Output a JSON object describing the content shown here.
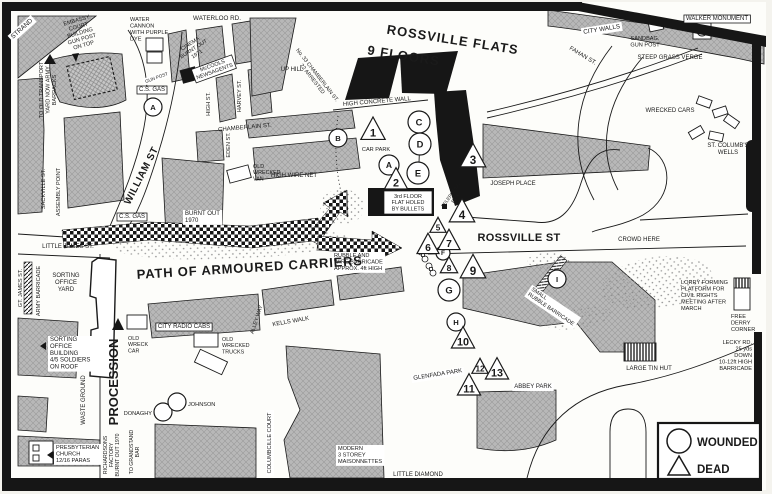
{
  "legend": {
    "wounded_label": "WOUNDED",
    "dead_label": "DEAD"
  },
  "colors": {
    "building_grey": "#b8b8b8",
    "flats_black": "#161616",
    "ink": "#1a1a1a",
    "paper": "#f4f3ee"
  },
  "labels": [
    {
      "n": "strand",
      "t": "STRAND",
      "x": 23,
      "y": 30,
      "s": 6.5,
      "r": -42,
      "box": 2
    },
    {
      "n": "embassy-court",
      "t": "EMBASSY\nCOURT\nBUILDING\nGUN POST\nON TOP",
      "x": 77,
      "y": 22,
      "s": 5.6,
      "r": -16
    },
    {
      "n": "water-cannon",
      "t": "WATER\nCANNON\nWITH PURPLE\nDYE",
      "x": 130,
      "y": 21,
      "s": 5.6,
      "a": "s"
    },
    {
      "n": "waterloo-rd",
      "t": "WATERLOO RD.",
      "x": 217,
      "y": 20,
      "s": 6.3
    },
    {
      "n": "transport-yard",
      "t": "TO OLD TRANSPORT\nYARD NOW ARMY\nBARRACKS",
      "x": 43,
      "y": 90,
      "s": 5.6,
      "r": -90
    },
    {
      "n": "cinema-burnt-out",
      "t": "CINEMA\nBURNT OUT\n1971",
      "x": 191,
      "y": 45,
      "s": 5.4,
      "r": -33
    },
    {
      "n": "mccools-newsagents",
      "t": "McCOOLS\nNEWSAGENTS",
      "x": 213,
      "y": 67,
      "s": 5.4,
      "r": -20,
      "box": 1
    },
    {
      "n": "cs-gas-north",
      "t": "C.S. GAS",
      "x": 152,
      "y": 91,
      "s": 6,
      "box": 1
    },
    {
      "n": "gun-post",
      "t": "GUN POST",
      "x": 157,
      "y": 79,
      "s": 4.6,
      "r": -20,
      "box": 2
    },
    {
      "n": "high-st",
      "t": "HIGH ST.",
      "x": 210,
      "y": 104,
      "s": 5.6,
      "r": -90
    },
    {
      "n": "harvey-st",
      "t": "HARVEY ST.",
      "x": 241,
      "y": 96,
      "s": 5.6,
      "r": -90
    },
    {
      "n": "chamberlain-st",
      "t": "CHAMBERLAIN ST.",
      "x": 245,
      "y": 129,
      "s": 6,
      "r": -5
    },
    {
      "n": "eden-st",
      "t": "EDEN ST.",
      "x": 230,
      "y": 145,
      "s": 5.6,
      "r": -90
    },
    {
      "n": "up-hill",
      "t": "UP HILL",
      "x": 292,
      "y": 71,
      "s": 6
    },
    {
      "n": "no33-chamberlain",
      "t": "No. 33 CHAMBERLAIN ST.\n22 ARRESTED",
      "x": 316,
      "y": 76,
      "s": 5.4,
      "r": 52
    },
    {
      "n": "rossville-flats",
      "t": "ROSSVILLE FLATS",
      "x": 452,
      "y": 44,
      "s": 13,
      "r": 9,
      "b": 1,
      "ls": 1
    },
    {
      "n": "nine-floors",
      "t": "9 FLOORS",
      "x": 403,
      "y": 60,
      "s": 13,
      "r": 9,
      "b": 1,
      "ls": 1
    },
    {
      "n": "high-concrete-wall",
      "t": "HIGH CONCRETE WALL",
      "x": 377,
      "y": 103,
      "s": 6,
      "r": -5
    },
    {
      "n": "car-park",
      "t": "CAR PARK",
      "x": 376,
      "y": 151,
      "s": 5.6
    },
    {
      "n": "old-wrecked-van",
      "t": "OLD\nWRECKED\nVAN",
      "x": 253,
      "y": 168,
      "s": 5.4,
      "a": "s"
    },
    {
      "n": "high-wire-net",
      "t": "HIGH WIRE NET",
      "x": 294,
      "y": 177,
      "s": 6
    },
    {
      "n": "cs-gas-south",
      "t": "C.S. GAS",
      "x": 132,
      "y": 218,
      "s": 6,
      "box": 1
    },
    {
      "n": "burnt-out-1970",
      "t": "BURNT OUT\n1970",
      "x": 185,
      "y": 215,
      "s": 6,
      "a": "s",
      "box": 2
    },
    {
      "n": "william-st",
      "t": "WILLIAM ST",
      "x": 144,
      "y": 177,
      "s": 10,
      "r": -63,
      "b": 1,
      "ls": 0.5
    },
    {
      "n": "sackville-st",
      "t": "SACKVILLE ST.",
      "x": 45,
      "y": 189,
      "s": 5.6,
      "r": -90
    },
    {
      "n": "assembly-point",
      "t": "ASSEMBLY POINT",
      "x": 60,
      "y": 192,
      "s": 5.6,
      "r": -90
    },
    {
      "n": "little-james-st",
      "t": "LITTLE JAMES ST.",
      "x": 68,
      "y": 248,
      "s": 6
    },
    {
      "n": "third-floor-flat",
      "t": "3rd FLOOR\nFLAT HOLED\nBY BULLETS",
      "x": 408,
      "y": 198,
      "s": 5.4
    },
    {
      "n": "telephone-box",
      "t": "TELEPHONE\nBOX",
      "x": 452,
      "y": 196,
      "s": 4.8,
      "r": -55
    },
    {
      "n": "joseph-place",
      "t": "JOSEPH PLACE",
      "x": 513,
      "y": 185,
      "s": 6
    },
    {
      "n": "rossville-st",
      "t": "ROSSVILLE ST",
      "x": 519,
      "y": 241,
      "s": 11,
      "b": 1,
      "ls": 0.3
    },
    {
      "n": "crowd-here",
      "t": "CROWD HERE",
      "x": 639,
      "y": 241,
      "s": 6
    },
    {
      "n": "st-columbs-wells",
      "t": "ST. COLUMB'S\nWELLS",
      "x": 728,
      "y": 147,
      "s": 6
    },
    {
      "n": "city-walls",
      "t": "CITY WALLS",
      "x": 602,
      "y": 31,
      "s": 6.3,
      "r": -9,
      "box": 2
    },
    {
      "n": "sandbag-gun-post",
      "t": "SANDBAG.\nGUN POST",
      "x": 645,
      "y": 40,
      "s": 5.6
    },
    {
      "n": "walker-monument",
      "t": "WALKER MONUMENT",
      "x": 717,
      "y": 20,
      "s": 6,
      "box": 1
    },
    {
      "n": "steep-grass-verge",
      "t": "STEEP GRASS VERGE",
      "x": 670,
      "y": 59,
      "s": 6
    },
    {
      "n": "fahan-st",
      "t": "FAHAN ST.",
      "x": 582,
      "y": 57,
      "s": 6,
      "r": 31
    },
    {
      "n": "wrecked-cars",
      "t": "WRECKED CARS",
      "x": 670,
      "y": 112,
      "s": 6
    },
    {
      "n": "rubble-wire-barricade",
      "t": "RUBBLE AND\nWIRE BARRICADE\nAPPROX. 4ft HIGH",
      "x": 334,
      "y": 257,
      "s": 5.6,
      "a": "s",
      "box": 2
    },
    {
      "n": "path-of-armoured-carriers",
      "t": "PATH OF ARMOURED CARRIERS",
      "x": 250,
      "y": 272,
      "s": 13,
      "r": -3.5,
      "b": 1,
      "ls": 0.8
    },
    {
      "n": "gt-james-st",
      "t": "GT. JAMES ST.",
      "x": 22,
      "y": 288,
      "s": 5.6,
      "r": -90
    },
    {
      "n": "army-barricade",
      "t": "ARMY BARRICADE",
      "x": 40,
      "y": 291,
      "s": 5.6,
      "r": -90
    },
    {
      "n": "sorting-office-yard",
      "t": "SORTING\nOFFICE\nYARD",
      "x": 66,
      "y": 277,
      "s": 6
    },
    {
      "n": "sorting-office-building",
      "t": "SORTING\nOFFICE\nBUILDING\n4/5 SOLDIERS\nON ROOF",
      "x": 50,
      "y": 341,
      "s": 6,
      "a": "s",
      "box": 2
    },
    {
      "n": "city-radio-cabs",
      "t": "CITY RADIO CABS",
      "x": 184,
      "y": 328,
      "s": 6,
      "box": 1
    },
    {
      "n": "old-wreck-car",
      "t": "OLD\nWRECK\nCAR",
      "x": 128,
      "y": 340,
      "s": 5.4,
      "a": "s"
    },
    {
      "n": "old-wrecked-trucks",
      "t": "OLD\nWRECKED\nTRUCKS",
      "x": 222,
      "y": 341,
      "s": 5.4,
      "a": "s"
    },
    {
      "n": "alley-way",
      "t": "ALLEY WAY",
      "x": 258,
      "y": 320,
      "s": 5.4,
      "r": -72
    },
    {
      "n": "kells-walk",
      "t": "KELLS WALK",
      "x": 291,
      "y": 323,
      "s": 6,
      "r": -10
    },
    {
      "n": "procession",
      "t": "PROCESSION",
      "x": 118,
      "y": 382,
      "s": 13,
      "r": -90,
      "b": 1
    },
    {
      "n": "waste-ground",
      "t": "WASTE GROUND",
      "x": 85,
      "y": 400,
      "s": 6,
      "r": -90
    },
    {
      "n": "donaghy",
      "t": "DONAGHY",
      "x": 152,
      "y": 415,
      "s": 5.6,
      "a": "e"
    },
    {
      "n": "johnson",
      "t": "JOHNSON",
      "x": 188,
      "y": 406,
      "s": 5.6,
      "a": "s"
    },
    {
      "n": "presbyterian-church",
      "t": "PRESBYTERIAN\nCHURCH\n12/16 PARAS",
      "x": 56,
      "y": 449,
      "s": 5.6,
      "a": "s",
      "box": 2
    },
    {
      "n": "richardsons-factory",
      "t": "RICHARDSONS\nFACTORY\nBURNT OUT 1970",
      "x": 107,
      "y": 455,
      "s": 5.2,
      "r": -90
    },
    {
      "n": "to-grandstand-bar",
      "t": "TO GRANDSTAND\nBAR",
      "x": 133,
      "y": 452,
      "s": 5.2,
      "r": -90
    },
    {
      "n": "columbcille-court",
      "t": "COLUMBCILLE COURT",
      "x": 271,
      "y": 443,
      "s": 5.6,
      "r": -90,
      "box": 2
    },
    {
      "n": "maisonnettes",
      "t": "MODERN\n3 STOREY\nMAISONNETTES",
      "x": 338,
      "y": 450,
      "s": 5.6,
      "a": "s",
      "box": 2
    },
    {
      "n": "little-diamond",
      "t": "LITTLE DIAMOND",
      "x": 418,
      "y": 476,
      "s": 6
    },
    {
      "n": "glenfada-park",
      "t": "GLENFADA PARK",
      "x": 438,
      "y": 376,
      "s": 6,
      "r": -9,
      "box": 2
    },
    {
      "n": "abbey-park",
      "t": "ABBEY PARK",
      "x": 533,
      "y": 388,
      "s": 6,
      "box": 2
    },
    {
      "n": "small-rubble-barricade",
      "t": "SMALL\nRUBBLE BARRICADE",
      "x": 531,
      "y": 290,
      "s": 5.4,
      "r": 34,
      "a": "s",
      "box": 2
    },
    {
      "n": "lorry-platform",
      "t": "LORRY FORMING\nPLATFORM FOR\nCIVIL RIGHTS\nMEETING AFTER\nMARCH",
      "x": 681,
      "y": 284,
      "s": 5.6,
      "a": "s"
    },
    {
      "n": "free-derry-corner",
      "t": "FREE\nDERRY\nCORNER",
      "x": 731,
      "y": 318,
      "s": 5.6,
      "a": "s"
    },
    {
      "n": "lecky-rd",
      "t": "LECKY RD.\n25 yds\nDOWN\n10-12ft HIGH\nBARRICADE",
      "x": 752,
      "y": 344,
      "s": 5.6,
      "a": "e"
    },
    {
      "n": "large-tin-hut",
      "t": "LARGE TIN HUT",
      "x": 649,
      "y": 370,
      "s": 6
    }
  ],
  "markers": {
    "wounded": [
      {
        "l": "A",
        "x": 153,
        "y": 107,
        "r": 9
      },
      {
        "l": "B",
        "x": 338,
        "y": 138,
        "r": 9
      },
      {
        "l": "C",
        "x": 419,
        "y": 122,
        "r": 11
      },
      {
        "l": "D",
        "x": 420,
        "y": 144,
        "r": 11
      },
      {
        "l": "A",
        "x": 389,
        "y": 165,
        "r": 10
      },
      {
        "l": "E",
        "x": 418,
        "y": 173,
        "r": 11
      },
      {
        "l": "F",
        "x": 443,
        "y": 253,
        "r": 7
      },
      {
        "l": "G",
        "x": 449,
        "y": 290,
        "r": 11
      },
      {
        "l": "H",
        "x": 456,
        "y": 322,
        "r": 9
      },
      {
        "l": "I",
        "x": 557,
        "y": 279,
        "r": 9
      },
      {
        "l": "",
        "x": 163,
        "y": 412,
        "r": 9
      },
      {
        "l": "",
        "x": 177,
        "y": 402,
        "r": 9
      }
    ],
    "dead": [
      {
        "num": "1",
        "x": 373,
        "y": 130,
        "s": 21
      },
      {
        "num": "2",
        "x": 396,
        "y": 180,
        "s": 20
      },
      {
        "num": "3",
        "x": 473,
        "y": 157,
        "s": 22
      },
      {
        "num": "4",
        "x": 462,
        "y": 212,
        "s": 22
      },
      {
        "num": "5",
        "x": 438,
        "y": 226,
        "s": 14
      },
      {
        "num": "6",
        "x": 428,
        "y": 245,
        "s": 19
      },
      {
        "num": "7",
        "x": 449,
        "y": 241,
        "s": 19
      },
      {
        "num": "8",
        "x": 449,
        "y": 266,
        "s": 15
      },
      {
        "num": "9",
        "x": 473,
        "y": 268,
        "s": 22
      },
      {
        "num": "10",
        "x": 463,
        "y": 339,
        "s": 20
      },
      {
        "num": "11",
        "x": 469,
        "y": 386,
        "s": 20
      },
      {
        "num": "12",
        "x": 480,
        "y": 367,
        "s": 14
      },
      {
        "num": "13",
        "x": 497,
        "y": 370,
        "s": 20
      }
    ]
  }
}
